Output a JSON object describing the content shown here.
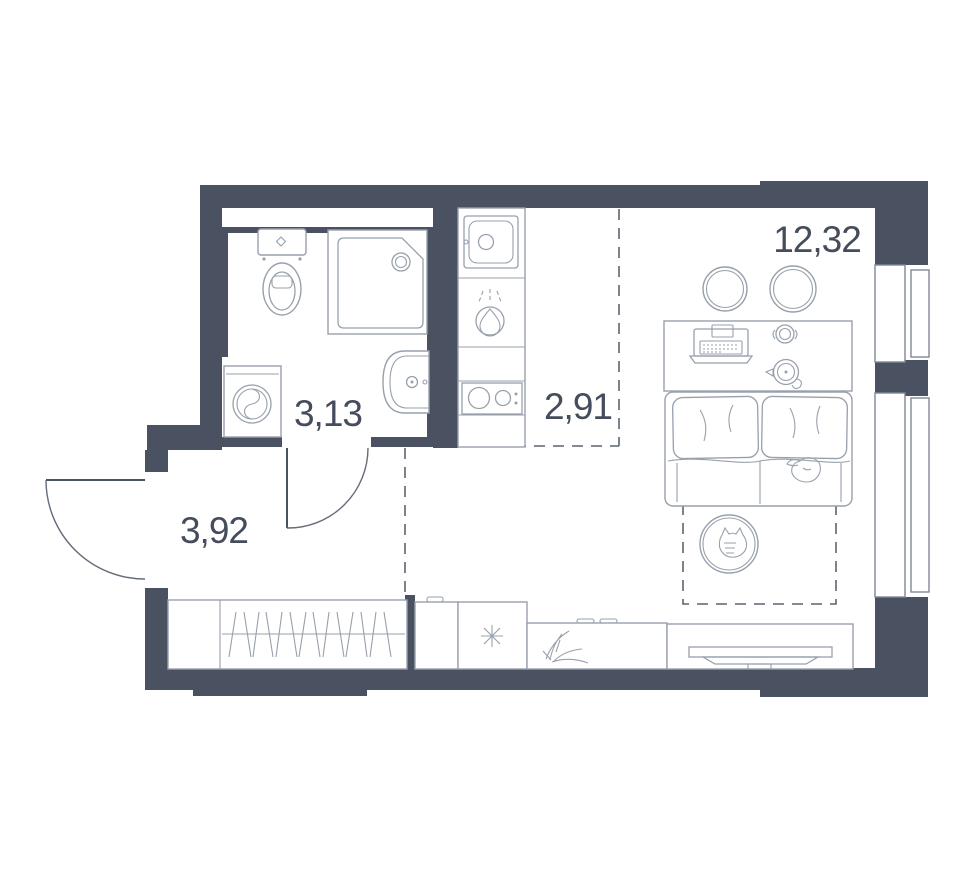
{
  "plan_title": "Studio apartment floor plan",
  "colors": {
    "wall": "#4a5160",
    "furniture_line": "#98a0ac",
    "window_frame": "#7f8797",
    "dashed_boundary": "#5b6372",
    "label_text": "#454c5c",
    "background": "#ffffff"
  },
  "rooms": {
    "bathroom": {
      "name": "bathroom",
      "area_label": "3,13",
      "fixtures": [
        "toilet-icon",
        "shower-cabin-icon",
        "washing-machine-icon",
        "bathroom-sink-icon"
      ]
    },
    "hallway": {
      "name": "hallway",
      "area_label": "3,92",
      "fixtures": [
        "entry-door-icon",
        "bathroom-door-icon",
        "wardrobe-icon"
      ]
    },
    "kitchen": {
      "name": "kitchen",
      "area_label": "2,91",
      "fixtures": [
        "kitchen-sink-icon",
        "cooker-hood-icon",
        "stove-icon",
        "fridge-icon",
        "base-cabinet-icon"
      ]
    },
    "living_room": {
      "name": "living-room",
      "area_label": "12,32",
      "fixtures": [
        "stool-icon",
        "stool-icon",
        "desk-icon",
        "laptop-icon",
        "cup-icon",
        "kettle-icon",
        "bed-icon",
        "pillow-icon",
        "pillow-icon",
        "dog-sketch-icon",
        "round-rug-icon",
        "cat-sketch-icon",
        "sideboard-icon",
        "plant-sketch-icon",
        "tv-stand-icon",
        "tv-icon",
        "window-icon",
        "window-icon"
      ]
    }
  }
}
